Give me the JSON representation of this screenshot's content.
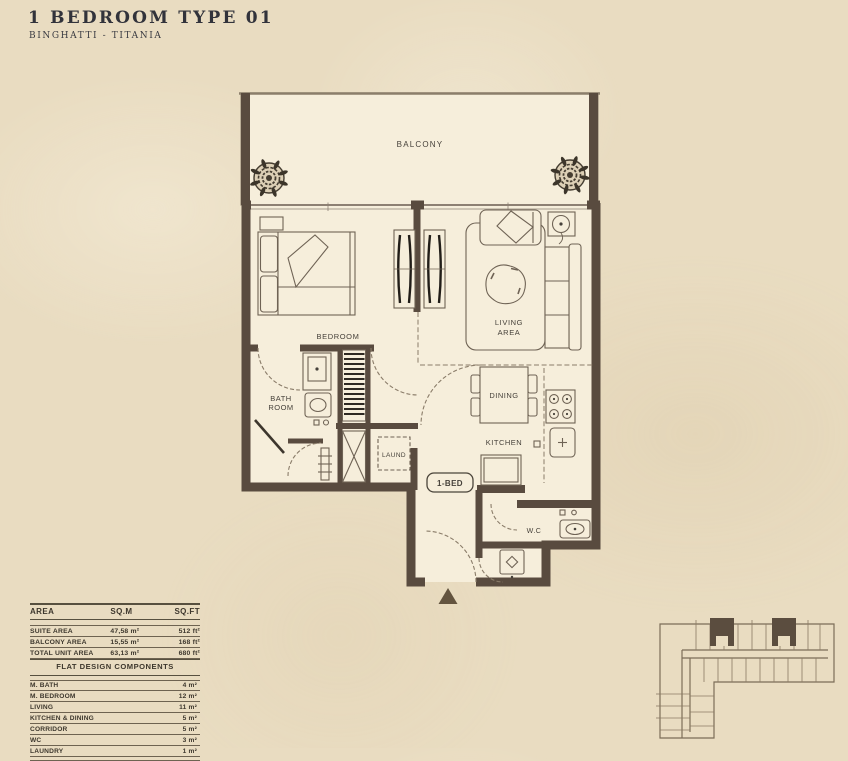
{
  "title": "1 BEDROOM TYPE 01",
  "subtitle": "BINGHATTI - TITANIA",
  "floorplan": {
    "labels": {
      "balcony": "BALCONY",
      "bedroom": "BEDROOM",
      "living1": "LIVING",
      "living2": "AREA",
      "bath1": "BATH",
      "bath2": "ROOM",
      "laundry": "LAUND",
      "dining": "DINING",
      "kitchen": "KITCHEN",
      "unit_badge": "1-BED",
      "wc": "W.C"
    }
  },
  "area_table": {
    "headers": [
      "AREA",
      "SQ.M",
      "SQ.FT"
    ],
    "rows": [
      {
        "name": "SUITE AREA",
        "sqm": "47,58 m²",
        "sqft": "512 ft²"
      },
      {
        "name": "BALCONY AREA",
        "sqm": "15,55 m²",
        "sqft": "168 ft²"
      },
      {
        "name": "TOTAL UNIT AREA",
        "sqm": "63,13 m²",
        "sqft": "680 ft²"
      }
    ]
  },
  "components_table": {
    "title": "FLAT DESIGN COMPONENTS",
    "rows": [
      {
        "name": "M. BATH",
        "value": "4 m²"
      },
      {
        "name": "M. BEDROOM",
        "value": "12 m²"
      },
      {
        "name": "LIVING",
        "value": "11 m²"
      },
      {
        "name": "KITCHEN & DINING",
        "value": "5 m²"
      },
      {
        "name": "CORRIDOR",
        "value": "5 m²"
      },
      {
        "name": "WC",
        "value": "3 m²"
      },
      {
        "name": "LAUNDRY",
        "value": "1 m²"
      }
    ]
  },
  "colors": {
    "paper": "#e9dcc1",
    "floor": "#f6eedb",
    "wall": "#594b3f",
    "line": "#6f6355",
    "dash": "#8a7c69",
    "title_text": "#32333b",
    "keyplan_unit": "#5b4d3f"
  }
}
